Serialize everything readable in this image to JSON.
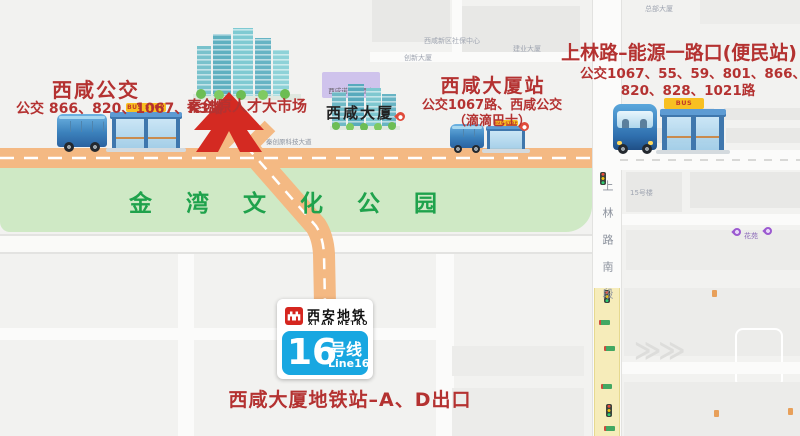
{
  "colors": {
    "annotation_red": "#b43231",
    "road_orange": "#f4b983",
    "park_green_bg": "#cfe9c5",
    "park_green_text": "#1fa24c",
    "metro_line_blue": "#18a7e1",
    "metro_logo_red": "#d5261f",
    "arrow_red": "#d42a22"
  },
  "signs": {
    "bus_stop": "BUS STOP"
  },
  "stops": {
    "left": {
      "title": "西咸公交",
      "routes": "公交 866、820、1067、K3路"
    },
    "center": {
      "title": "西咸大厦站",
      "routes1": "公交1067路、西咸公交",
      "routes2": "（滴滴巴士）"
    },
    "right": {
      "title": "上林路–能源一路口(便民站)",
      "routes1": "公交1067、55、59、801、866、",
      "routes2": "820、828、1021路"
    }
  },
  "market_label": "秦创原人才大市场",
  "park_label": "金湾文化公园",
  "building_label": "西咸大厦",
  "hotel_label": "西咸诺富特酒店",
  "road_label": "秦创原科技大道",
  "street_label": "上林路南段",
  "metro": {
    "name_cn": "西安地铁",
    "name_en": "XI'AN METRO",
    "line_number": "16",
    "line_suffix": "号线",
    "line_en": "Line16"
  },
  "exit_label": "西咸大厦地铁站–A、D出口",
  "map_labels": {
    "shebao": "西咸新区社保中心",
    "chuangxin": "创新大厦",
    "jianye": "建业大厦",
    "zongbu": "总部大厦",
    "building15": "15号楼",
    "huayuan": "花苑"
  }
}
